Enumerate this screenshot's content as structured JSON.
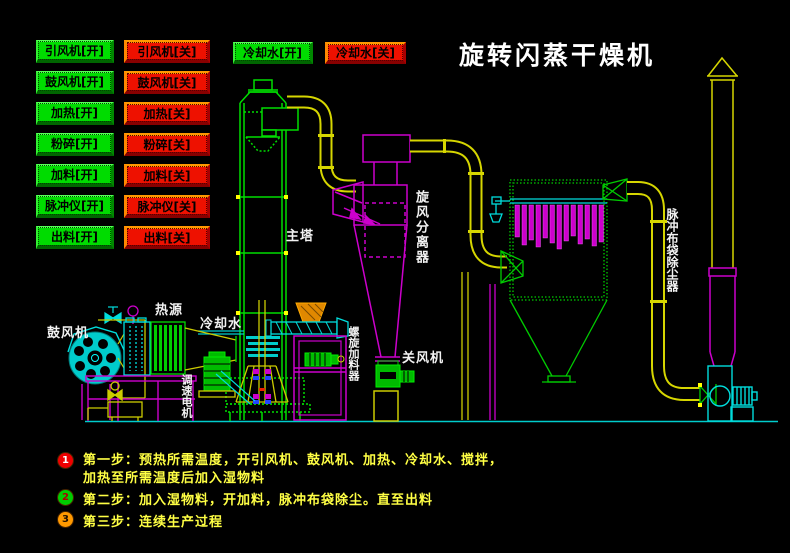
{
  "title": "旋转闪蒸干燥机",
  "palette": {
    "background": "#000000",
    "button_on": "#00dc00",
    "button_off": "#ee1100",
    "button_off_bevel": "#ff8800",
    "diagram_green": "#00dd00",
    "diagram_cyan": "#00dddd",
    "diagram_magenta": "#cc00cc",
    "diagram_yellow": "#d6d600",
    "hopper_orange": "#e08800",
    "step_text": "#ffff44",
    "title_color": "#ffffff",
    "label_color": "#f2f2f2"
  },
  "control_panel": {
    "on_buttons": [
      "引风机[开]",
      "鼓风机[开]",
      "加热[开]",
      "粉碎[开]",
      "加料[开]",
      "脉冲仪[开]",
      "出料[开]"
    ],
    "off_buttons": [
      "引风机[关]",
      "鼓风机[关]",
      "加热[关]",
      "粉碎[关]",
      "加料[关]",
      "脉冲仪[关]",
      "出料[关]"
    ],
    "cooling_on": "冷却水[开]",
    "cooling_off": "冷却水[关]"
  },
  "diagram_labels": {
    "main_tower": "主塔",
    "cyclone": "旋风分离器",
    "bag_filter": "脉冲布袋除尘器",
    "blower": "鼓风机",
    "heat_source": "热源",
    "cooling_water": "冷却水",
    "speed_motor": "调速电机",
    "screw_feeder": "螺旋加料器",
    "rotary_valve": "关风机"
  },
  "steps": [
    {
      "num": "1",
      "circle_color": "#ee0000",
      "num_color": "#ffffff",
      "line1": "第一步：预热所需温度，开引风机、鼓风机、加热、冷却水、搅拌，",
      "line2": "加热至所需温度后加入湿物料"
    },
    {
      "num": "2",
      "circle_color": "#00cc00",
      "num_color": "#aa0000",
      "line1": "第二步：加入湿物料，开加料，脉冲布袋除尘。直至出料",
      "line2": ""
    },
    {
      "num": "3",
      "circle_color": "#ff9900",
      "num_color": "#221100",
      "line1": "第三步：连续生产过程",
      "line2": ""
    }
  ]
}
